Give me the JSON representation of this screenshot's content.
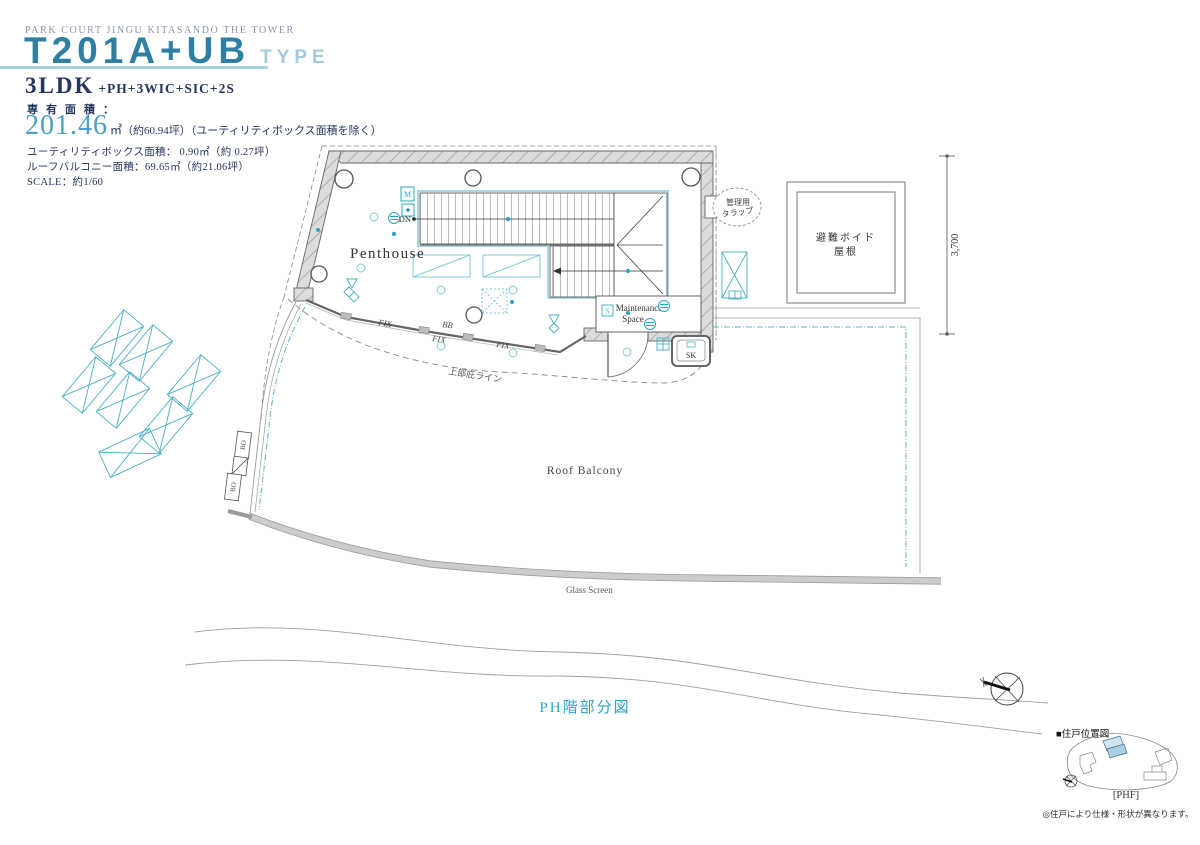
{
  "header": {
    "project": "PARK COURT JINGU KITASANDO THE TOWER",
    "type_name": "T201A+UB",
    "type_suffix": "TYPE",
    "layout": "3LDK",
    "layout_suffix": "+PH+3WIC+SIC+2S",
    "area_label": "専有面積：",
    "area_value": "201.46",
    "area_unit": "㎡",
    "area_note": "（約60.94坪）（ユーティリティボックス面積を除く）",
    "utility_line": "ユーティリティボックス面積： 0.90㎡（約 0.27坪）",
    "roof_balcony_line": "ルーフバルコニー面積：69.65㎡（約21.06坪）",
    "scale_line": "SCALE：約1/60"
  },
  "plan": {
    "room_label": "Penthouse",
    "stair_down": "DN",
    "maintenance_1": "Maintenance",
    "maintenance_2": "Space",
    "sink": "SK",
    "fix": "FIX",
    "bb": "BB",
    "bo": "BO",
    "meter": "M",
    "switch": "S",
    "access_ladder_1": "管理用",
    "access_ladder_2": "タラップ",
    "void_roof_1": "避難ボイド",
    "void_roof_2": "屋根",
    "dimension": "3,700",
    "eave_line": "上部庇ライン",
    "roof_balcony": "Roof Balcony",
    "glass_screen": "Glass Screen"
  },
  "footer": {
    "caption": "PH階部分図"
  },
  "locator": {
    "title": "■住戸位置図",
    "floor": "[PHF]",
    "note": "◎住戸により仕様・形状が異なります。"
  },
  "colors": {
    "title_blue": "#2e7fa2",
    "title_light_blue": "#a2cadd",
    "navy": "#26365c",
    "area_teal": "#4aa0c4",
    "caption_teal": "#2fa3c7",
    "plan_teal": "#49b0c2",
    "wall_gray": "#d9d9d9"
  }
}
